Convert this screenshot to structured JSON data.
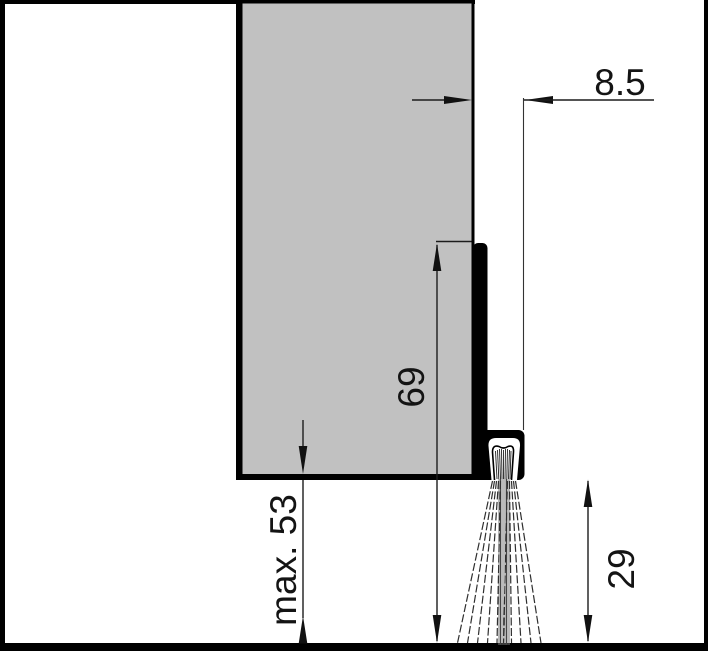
{
  "meta": {
    "title": "Cross-section drawing of a door-bottom brush seal",
    "width_px": 708,
    "height_px": 651
  },
  "colors": {
    "background": "#ffffff",
    "outline": "#000000",
    "door_fill": "#c1c1c1",
    "dimension_line": "#1c1c1c",
    "extension_line": "#333333",
    "brush_stroke": "#2f2f2f",
    "brush_center": "#777777",
    "text": "#141414"
  },
  "drawing": {
    "parts": {
      "door_panel": "door-leaf-section",
      "carrier_profile": "brush-seal-carrier-profile",
      "brush": "brush-strands",
      "floor": "floor-line"
    },
    "labels": {
      "depth": "8.5",
      "height": "69",
      "max_gap": "max. 53",
      "brush_drop": "29"
    }
  }
}
